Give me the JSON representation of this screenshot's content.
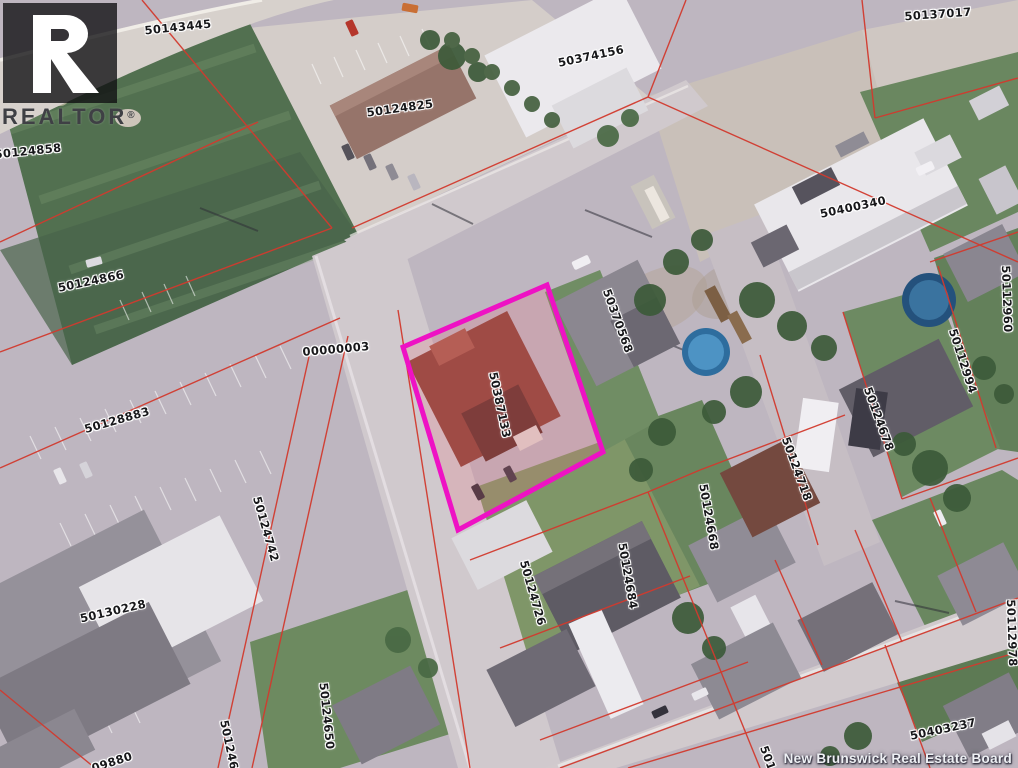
{
  "watermark": {
    "logo_letter": "R",
    "logo_word": "REALTOR",
    "registered_mark": "®"
  },
  "attribution": {
    "text": "New Brunswick Real Estate Board"
  },
  "map": {
    "type": "cadastral-aerial",
    "highlighted_parcel_id": "50387133",
    "highlight_color": "#ee12c4",
    "boundary_color": "#d23a2e",
    "label_text_color": "#17171a",
    "label_halo_color": "#ffffff",
    "parcel_labels": [
      {
        "id": "50143445",
        "x": 178,
        "y": 27,
        "rot": -6
      },
      {
        "id": "50137017",
        "x": 938,
        "y": 14,
        "rot": -4
      },
      {
        "id": "50374156",
        "x": 591,
        "y": 56,
        "rot": -12
      },
      {
        "id": "50124825",
        "x": 400,
        "y": 108,
        "rot": -8
      },
      {
        "id": "50124858",
        "x": 28,
        "y": 151,
        "rot": -6
      },
      {
        "id": "50124866",
        "x": 91,
        "y": 281,
        "rot": -12
      },
      {
        "id": "00000003",
        "x": 336,
        "y": 349,
        "rot": -5
      },
      {
        "id": "50128883",
        "x": 117,
        "y": 420,
        "rot": -16
      },
      {
        "id": "50400340",
        "x": 853,
        "y": 207,
        "rot": -12
      },
      {
        "id": "50370568",
        "x": 618,
        "y": 321,
        "rot": 70
      },
      {
        "id": "50387133",
        "x": 500,
        "y": 405,
        "rot": 78
      },
      {
        "id": "50112960",
        "x": 1007,
        "y": 299,
        "rot": 88
      },
      {
        "id": "50112994",
        "x": 963,
        "y": 361,
        "rot": 72
      },
      {
        "id": "50124678",
        "x": 879,
        "y": 419,
        "rot": 70
      },
      {
        "id": "50124718",
        "x": 797,
        "y": 469,
        "rot": 70
      },
      {
        "id": "50124668",
        "x": 709,
        "y": 517,
        "rot": 80
      },
      {
        "id": "50124684",
        "x": 628,
        "y": 576,
        "rot": 80
      },
      {
        "id": "50124726",
        "x": 533,
        "y": 593,
        "rot": 74
      },
      {
        "id": "50124742",
        "x": 266,
        "y": 529,
        "rot": 74
      },
      {
        "id": "50130228",
        "x": 113,
        "y": 611,
        "rot": -13
      },
      {
        "id": "50124650",
        "x": 327,
        "y": 716,
        "rot": 84
      },
      {
        "id": "50124643",
        "x": 231,
        "y": 753,
        "rot": 78
      },
      {
        "id": "50112978",
        "x": 1012,
        "y": 633,
        "rot": 88
      },
      {
        "id": "50403237",
        "x": 943,
        "y": 729,
        "rot": -12
      },
      {
        "id": "09880",
        "x": 112,
        "y": 762,
        "rot": -18,
        "partial": true
      },
      {
        "id": "501",
        "x": 768,
        "y": 758,
        "rot": 70,
        "partial": true
      }
    ]
  }
}
